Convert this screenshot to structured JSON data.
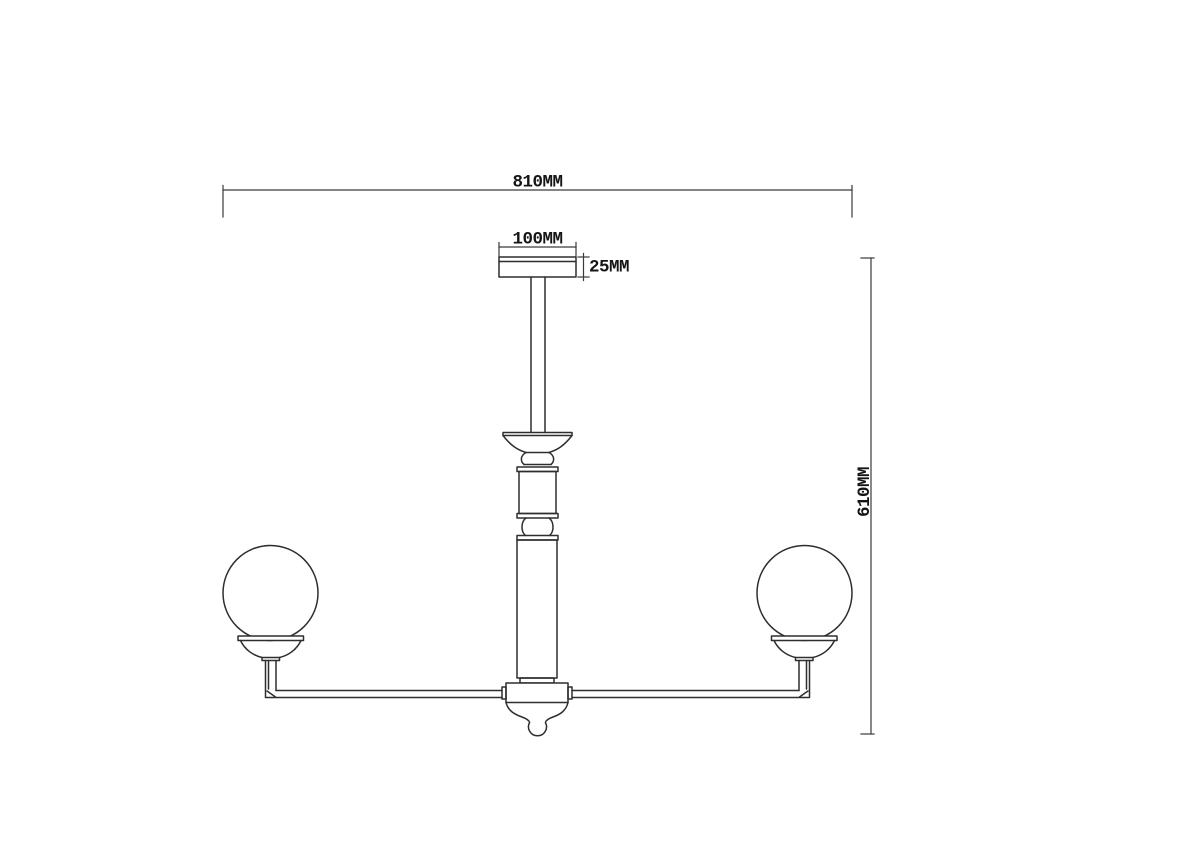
{
  "page": {
    "background_color": "#ffffff"
  },
  "drawing": {
    "kind": "technical dimension diagram of a two-arm globe chandelier, front elevation",
    "line_color": "#2e2e2e",
    "dimension_line_color": "#3a3a3a",
    "label_color": "#151515",
    "labels": {
      "overall_width": "810MM",
      "canopy_width": "100MM",
      "canopy_height": "25MM",
      "overall_height": "610MM"
    },
    "values_mm": {
      "overall_width": 810,
      "canopy_width": 100,
      "canopy_height": 25,
      "overall_height": 610
    }
  }
}
